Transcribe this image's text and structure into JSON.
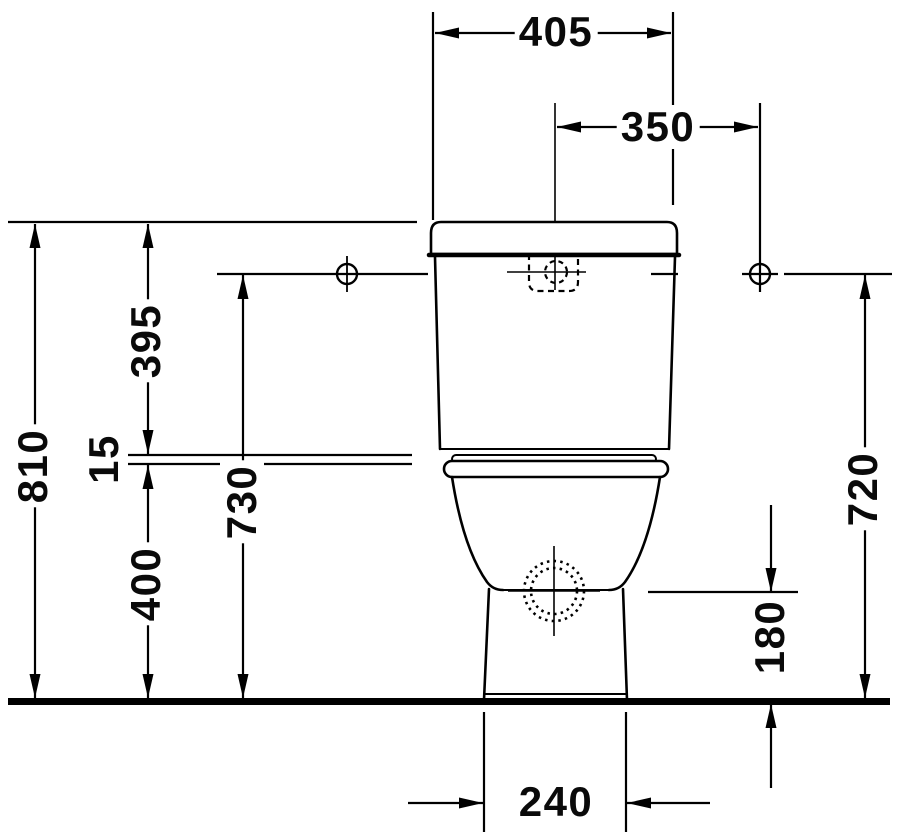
{
  "dims": {
    "top_width": "405",
    "hole_offset": "350",
    "total_height": "810",
    "tank_height": "395",
    "seat_joint": "15",
    "bowl_rim_height": "400",
    "fixing_hole_height": "730",
    "right_fixing_height": "720",
    "outlet_height": "180",
    "outlet_base_width": "240"
  },
  "colors": {
    "line": "#000000",
    "background": "#ffffff"
  }
}
